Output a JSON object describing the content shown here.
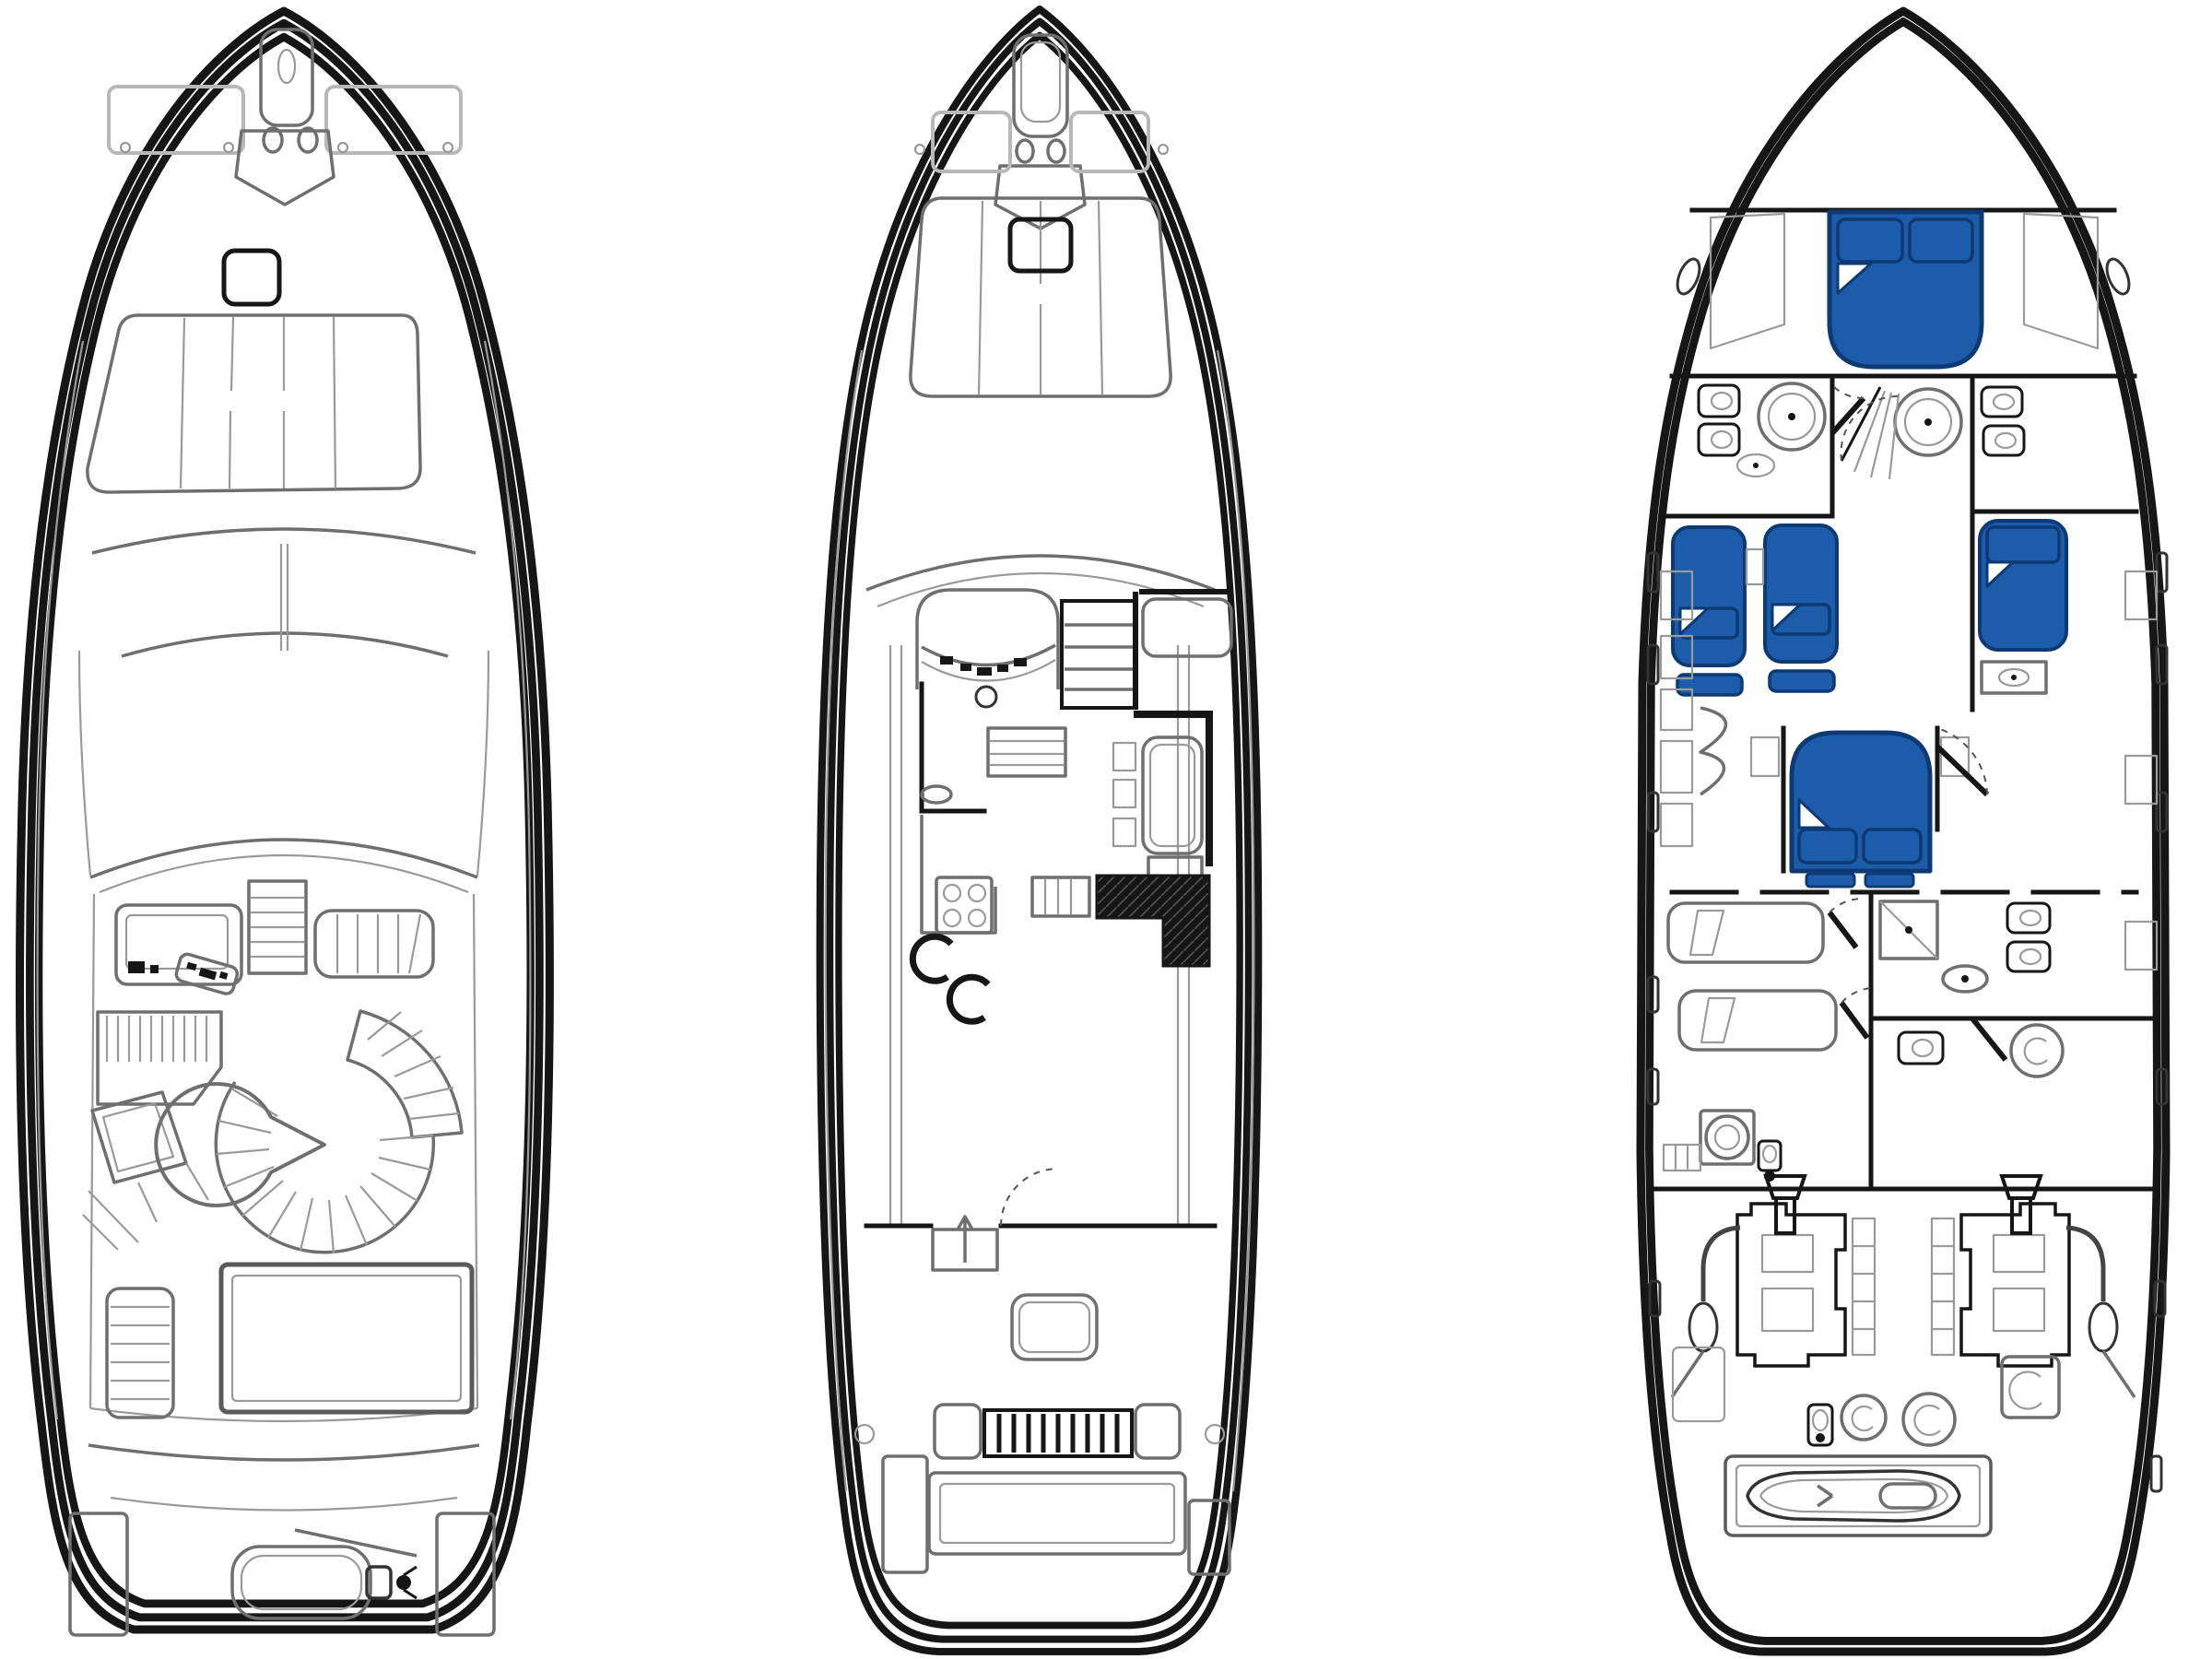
{
  "diagram": {
    "type": "yacht-deck-plan",
    "style": "technical-line-drawing",
    "views": [
      {
        "name": "flybridge-deck",
        "position": "left",
        "features": [
          "anchor-locker",
          "windlass-capstans",
          "bow-deck-plates",
          "foredeck-sunpad",
          "headrest-cushion",
          "windshield",
          "helm-console",
          "helm-seat",
          "companion-bench",
          "port-lounge-seat",
          "cockpit-table",
          "curved-settee",
          "spiral-staircase",
          "aft-skylight",
          "boarding-ladder",
          "swim-platform",
          "platform-steps",
          "tender-with-outboard"
        ]
      },
      {
        "name": "main-deck",
        "position": "center",
        "features": [
          "anchor-locker",
          "windlass-capstans",
          "bow-hatches",
          "foredeck-sunpad",
          "headrest-cushion",
          "windshield",
          "helm-station",
          "instrument-panel",
          "companionway-stairs",
          "navigator-settee",
          "galley-counter",
          "stove",
          "sink",
          "bar-stools",
          "dinette-table",
          "fold-chairs",
          "l-shaped-sofa",
          "aft-settee",
          "sideboard",
          "cockpit-door",
          "cockpit-floor-hatch",
          "transom-seat",
          "swim-platform",
          "platform-steps"
        ]
      },
      {
        "name": "lower-deck",
        "position": "right",
        "features": [
          "vip-cabin-double-berth",
          "port-head",
          "starboard-head",
          "vanity-sinks",
          "companionway-fan-stairs",
          "guest-cabin-twin-berths",
          "starboard-guest-berth",
          "wardrobe",
          "master-cabin-double-berth",
          "master-head",
          "shower-stall",
          "toilet",
          "bidet",
          "crew-berths",
          "washer",
          "utility-cabinets",
          "engine-room",
          "twin-engines",
          "air-intakes",
          "exhaust-pipes",
          "generators",
          "stern-garage",
          "jet-ski-tender",
          "hull-portlights"
        ]
      }
    ]
  },
  "colors": {
    "background": "#ffffff",
    "line_black": "#161616",
    "line_dark": "#3a3a3a",
    "line_gray": "#8e8e8e",
    "line_light": "#b8b8b8",
    "accent_blue": "#1d5ca9",
    "accent_blue_dark": "#0d3a75",
    "sofa_dark": "#161616"
  }
}
